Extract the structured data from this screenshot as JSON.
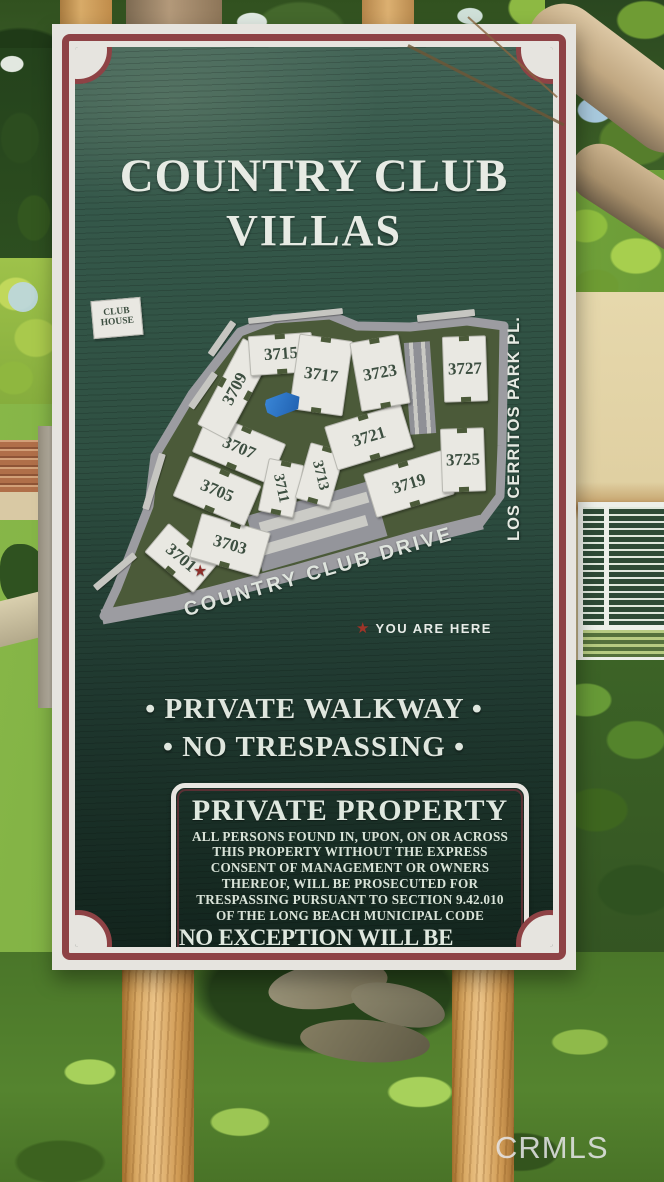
{
  "sign": {
    "title_line1": "COUNTRY CLUB",
    "title_line2": "VILLAS",
    "map": {
      "street_main": "COUNTRY CLUB DRIVE",
      "street_side": "LOS CERRITOS PARK PL.",
      "you_are_here": "YOU ARE HERE",
      "clubhouse_lines": [
        "CLUB",
        "HOUSE"
      ],
      "buildings": [
        {
          "label": "3701",
          "x": 88,
          "y": 258,
          "w": 62,
          "h": 36,
          "rot": 40
        },
        {
          "label": "3703",
          "x": 137,
          "y": 245,
          "w": 70,
          "h": 44,
          "rot": 16
        },
        {
          "label": "3705",
          "x": 124,
          "y": 191,
          "w": 76,
          "h": 42,
          "rot": 23
        },
        {
          "label": "3707",
          "x": 146,
          "y": 148,
          "w": 82,
          "h": 42,
          "rot": 23
        },
        {
          "label": "3709",
          "x": 142,
          "y": 89,
          "w": 96,
          "h": 32,
          "rot": -62
        },
        {
          "label": "3711",
          "x": 188,
          "y": 188,
          "w": 34,
          "h": 52,
          "rot": 12,
          "labelRot": 66,
          "small": true
        },
        {
          "label": "3713",
          "x": 227,
          "y": 175,
          "w": 34,
          "h": 56,
          "rot": 16,
          "labelRot": 60,
          "small": true
        },
        {
          "label": "3715",
          "x": 188,
          "y": 54,
          "w": 62,
          "h": 38,
          "rot": -4
        },
        {
          "label": "3717",
          "x": 228,
          "y": 75,
          "w": 52,
          "h": 74,
          "rot": 8
        },
        {
          "label": "3719",
          "x": 316,
          "y": 184,
          "w": 80,
          "h": 44,
          "rot": -17
        },
        {
          "label": "3721",
          "x": 276,
          "y": 137,
          "w": 78,
          "h": 44,
          "rot": -17
        },
        {
          "label": "3723",
          "x": 287,
          "y": 73,
          "w": 48,
          "h": 68,
          "rot": -10
        },
        {
          "label": "3725",
          "x": 370,
          "y": 160,
          "w": 42,
          "h": 62,
          "rot": -2
        },
        {
          "label": "3727",
          "x": 372,
          "y": 69,
          "w": 42,
          "h": 64,
          "rot": -2
        }
      ]
    },
    "notice_line1": "• PRIVATE WALKWAY •",
    "notice_line2": "• NO TRESPASSING •",
    "private_property": {
      "heading": "PRIVATE PROPERTY",
      "body_lines": [
        "ALL PERSONS FOUND IN, UPON, ON OR ACROSS",
        "THIS PROPERTY WITHOUT THE EXPRESS",
        "CONSENT OF MANAGEMENT OR OWNERS",
        "THEREOF, WILL BE PROSECUTED FOR",
        "TRESPASSING PURSUANT TO SECTION 9.42.010",
        "OF THE LONG BEACH MUNICIPAL CODE"
      ],
      "emphasis": "NO EXCEPTION WILL BE MADE",
      "phone": "L.B.P.D. 435-6711"
    },
    "colors": {
      "panel_green": "#2e4f41",
      "border_maroon": "#8e4245",
      "map_olive": "#4b5a39",
      "road_gray": "#9c9ca1",
      "pool_blue": "#2b76c8",
      "star_red": "#8d2f2b"
    }
  },
  "icons": {
    "you_are_here_star": "★"
  },
  "watermark": "CRMLS"
}
